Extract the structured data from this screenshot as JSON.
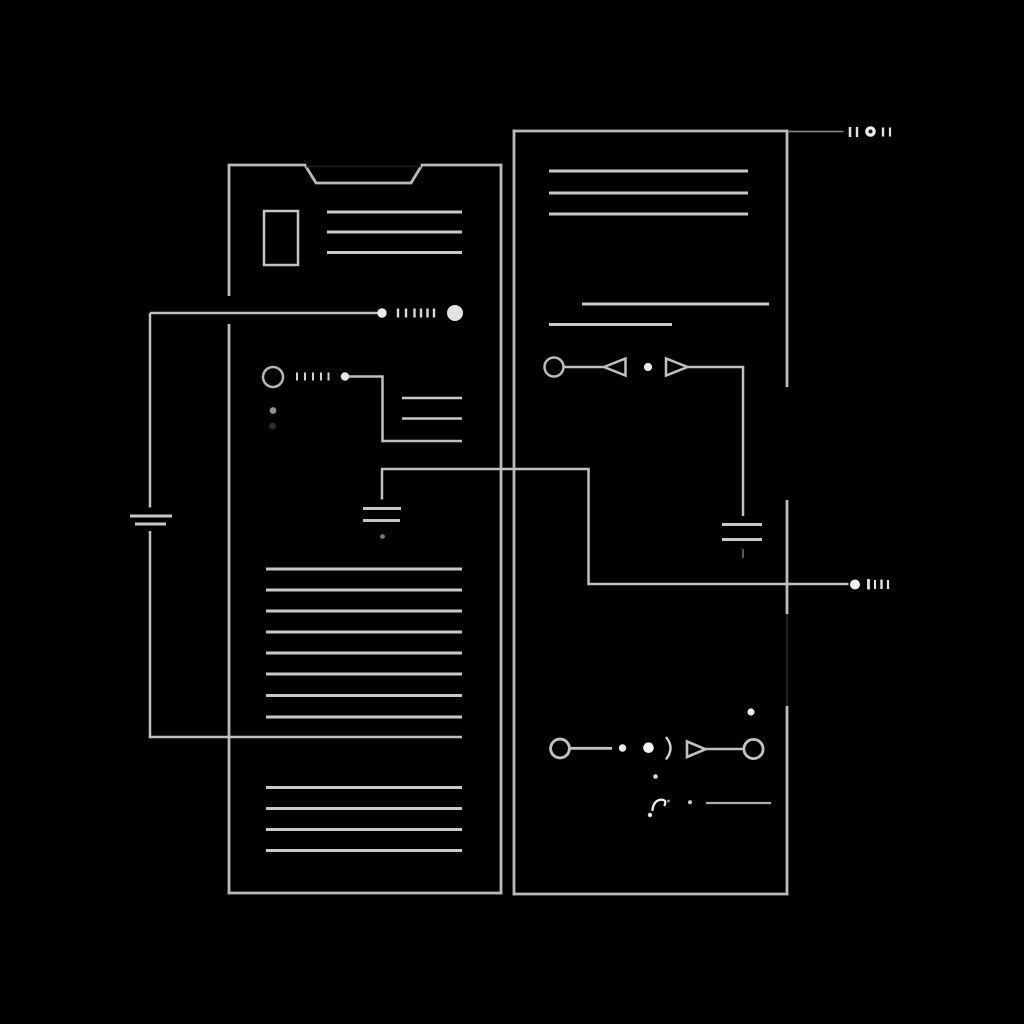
{
  "canvas": {
    "width": 1024,
    "height": 1024,
    "background": "#000000"
  },
  "palette": {
    "panel_stroke": "#b9b9b9",
    "text_line": "#c9c9c9",
    "wire": "#c0c0c0",
    "bright_dot": "#f2f2f2",
    "ghost": "#232323"
  },
  "shapes": [
    {
      "name": "left-panel-edge-left-upper",
      "type": "line",
      "x1": 229,
      "y1": 165,
      "x2": 229,
      "y2": 296,
      "w": 2.8,
      "color": "#b9b9b9"
    },
    {
      "name": "left-panel-edge-left-lower",
      "type": "line",
      "x1": 229,
      "y1": 324,
      "x2": 229,
      "y2": 894.4,
      "w": 2.8,
      "color": "#b9b9b9"
    },
    {
      "name": "left-panel-edge-right",
      "type": "line",
      "x1": 501,
      "y1": 163.6,
      "x2": 501,
      "y2": 894.4,
      "w": 2.8,
      "color": "#b9b9b9"
    },
    {
      "name": "left-panel-edge-top-left",
      "type": "line",
      "x1": 227.6,
      "y1": 165,
      "x2": 306,
      "y2": 165,
      "w": 2.8,
      "color": "#b9b9b9"
    },
    {
      "name": "left-panel-notch-left-slant",
      "type": "line",
      "x1": 305,
      "y1": 165,
      "x2": 316,
      "y2": 183,
      "w": 2.8,
      "color": "#b9b9b9"
    },
    {
      "name": "left-panel-notch-bottom",
      "type": "line",
      "x1": 315,
      "y1": 183,
      "x2": 412,
      "y2": 183,
      "w": 2.8,
      "color": "#b9b9b9"
    },
    {
      "name": "left-panel-notch-right-slant",
      "type": "line",
      "x1": 411,
      "y1": 183,
      "x2": 422,
      "y2": 165,
      "w": 2.8,
      "color": "#b9b9b9"
    },
    {
      "name": "left-panel-edge-top-right",
      "type": "line",
      "x1": 421,
      "y1": 165,
      "x2": 502.4,
      "y2": 165,
      "w": 2.8,
      "color": "#b9b9b9"
    },
    {
      "name": "left-panel-notch-ghost-line",
      "type": "line",
      "x1": 306,
      "y1": 166.5,
      "x2": 421,
      "y2": 166.5,
      "w": 1.5,
      "color": "#1d1d1d"
    },
    {
      "name": "left-panel-edge-bottom",
      "type": "line",
      "x1": 227.6,
      "y1": 893,
      "x2": 502.4,
      "y2": 893,
      "w": 2.8,
      "color": "#b9b9b9"
    },
    {
      "name": "right-panel-edge-left",
      "type": "line",
      "x1": 514,
      "y1": 129.6,
      "x2": 514,
      "y2": 895.4,
      "w": 2.8,
      "color": "#b9b9b9"
    },
    {
      "name": "right-panel-edge-top",
      "type": "line",
      "x1": 512.6,
      "y1": 131,
      "x2": 788.4,
      "y2": 131,
      "w": 2.8,
      "color": "#b9b9b9"
    },
    {
      "name": "right-panel-edge-right-upper",
      "type": "line",
      "x1": 787,
      "y1": 129.6,
      "x2": 787,
      "y2": 387,
      "w": 2.8,
      "color": "#b9b9b9"
    },
    {
      "name": "right-panel-edge-right-middle",
      "type": "line",
      "x1": 787,
      "y1": 500,
      "x2": 787,
      "y2": 614,
      "w": 2.8,
      "color": "#b9b9b9"
    },
    {
      "name": "right-panel-edge-right-ghost",
      "type": "line",
      "x1": 787,
      "y1": 614,
      "x2": 787,
      "y2": 706,
      "w": 2,
      "color": "#232323"
    },
    {
      "name": "right-panel-edge-right-lower",
      "type": "line",
      "x1": 787,
      "y1": 706,
      "x2": 787,
      "y2": 895.4,
      "w": 2.8,
      "color": "#b9b9b9"
    },
    {
      "name": "right-panel-edge-bottom",
      "type": "line",
      "x1": 512.6,
      "y1": 894,
      "x2": 788.4,
      "y2": 894,
      "w": 2.8,
      "color": "#b9b9b9"
    },
    {
      "name": "left-panel-small-rect",
      "type": "rect",
      "x": 264,
      "y": 211,
      "width": 34,
      "height": 54,
      "s": 2.5,
      "color": "#c3c3c3"
    },
    {
      "name": "left-text-line-a1",
      "type": "line",
      "x1": 327,
      "y1": 212,
      "x2": 462,
      "y2": 212,
      "w": 3,
      "color": "#c9c9c9"
    },
    {
      "name": "left-text-line-a2",
      "type": "line",
      "x1": 327,
      "y1": 232,
      "x2": 462,
      "y2": 232,
      "w": 3,
      "color": "#c9c9c9"
    },
    {
      "name": "left-text-line-a3",
      "type": "line",
      "x1": 327,
      "y1": 252.5,
      "x2": 462,
      "y2": 252.5,
      "w": 3,
      "color": "#c9c9c9"
    },
    {
      "name": "wire-row1-horizontal",
      "type": "line",
      "x1": 150,
      "y1": 313,
      "x2": 377.5,
      "y2": 313,
      "w": 2.5,
      "color": "#c0c0c0"
    },
    {
      "name": "wire-row1-node-dot",
      "type": "dot",
      "cx": 382,
      "cy": 313,
      "r": 4.7,
      "color": "#ececec"
    },
    {
      "name": "wire-row1-tick-1",
      "type": "line",
      "x1": 398,
      "y1": 308.5,
      "x2": 398,
      "y2": 317.5,
      "w": 2.4,
      "color": "#d8d8d8"
    },
    {
      "name": "wire-row1-tick-2",
      "type": "line",
      "x1": 406,
      "y1": 308.5,
      "x2": 406,
      "y2": 317.5,
      "w": 2.4,
      "color": "#d8d8d8"
    },
    {
      "name": "wire-row1-tick-3",
      "type": "line",
      "x1": 414.5,
      "y1": 308.5,
      "x2": 414.5,
      "y2": 317.5,
      "w": 2.4,
      "color": "#d8d8d8"
    },
    {
      "name": "wire-row1-tick-4",
      "type": "line",
      "x1": 421,
      "y1": 308.5,
      "x2": 421,
      "y2": 317.5,
      "w": 2.4,
      "color": "#d8d8d8"
    },
    {
      "name": "wire-row1-tick-5",
      "type": "line",
      "x1": 427.5,
      "y1": 308.5,
      "x2": 427.5,
      "y2": 317.5,
      "w": 2.4,
      "color": "#d8d8d8"
    },
    {
      "name": "wire-row1-tick-6",
      "type": "line",
      "x1": 434,
      "y1": 308.5,
      "x2": 434,
      "y2": 317.5,
      "w": 2.4,
      "color": "#d8d8d8"
    },
    {
      "name": "wire-row1-terminal-circle",
      "type": "dot",
      "cx": 455,
      "cy": 313,
      "r": 8,
      "color": "#e2e2e2"
    },
    {
      "name": "left-wire-vertical-upper",
      "type": "line",
      "x1": 150,
      "y1": 313,
      "x2": 150,
      "y2": 507.5,
      "w": 2.5,
      "color": "#c0c0c0"
    },
    {
      "name": "left-ground-bar-1",
      "type": "line",
      "x1": 130,
      "y1": 516,
      "x2": 172,
      "y2": 516,
      "w": 3,
      "color": "#c6c6c6"
    },
    {
      "name": "left-ground-bar-2",
      "type": "line",
      "x1": 135,
      "y1": 524,
      "x2": 166,
      "y2": 524,
      "w": 3,
      "color": "#c6c6c6"
    },
    {
      "name": "left-wire-vertical-lower",
      "type": "line",
      "x1": 150,
      "y1": 531,
      "x2": 150,
      "y2": 738.2,
      "w": 2.5,
      "color": "#c0c0c0"
    },
    {
      "name": "left-wire-horizontal-bottom",
      "type": "line",
      "x1": 148.8,
      "y1": 737,
      "x2": 462,
      "y2": 737,
      "w": 2.5,
      "color": "#c0c0c0"
    },
    {
      "name": "circle-row-circle",
      "type": "circle",
      "cx": 273,
      "cy": 377,
      "r": 10,
      "s": 2.5,
      "color": "#b5b5b5"
    },
    {
      "name": "circle-row-tick-1",
      "type": "line",
      "x1": 297,
      "y1": 372.5,
      "x2": 297,
      "y2": 380.5,
      "w": 2,
      "color": "#cfcfcf"
    },
    {
      "name": "circle-row-tick-2",
      "type": "line",
      "x1": 305,
      "y1": 372.5,
      "x2": 305,
      "y2": 380.5,
      "w": 2,
      "color": "#cfcfcf"
    },
    {
      "name": "circle-row-tick-3",
      "type": "line",
      "x1": 313,
      "y1": 372.5,
      "x2": 313,
      "y2": 380.5,
      "w": 2,
      "color": "#cfcfcf"
    },
    {
      "name": "circle-row-tick-4",
      "type": "line",
      "x1": 321,
      "y1": 372.5,
      "x2": 321,
      "y2": 380.5,
      "w": 2,
      "color": "#cfcfcf"
    },
    {
      "name": "circle-row-tick-5",
      "type": "line",
      "x1": 328.5,
      "y1": 372.5,
      "x2": 328.5,
      "y2": 380.5,
      "w": 2,
      "color": "#cfcfcf"
    },
    {
      "name": "circle-row-dot",
      "type": "dot",
      "cx": 345,
      "cy": 376.5,
      "r": 4.2,
      "color": "#e8e8e8"
    },
    {
      "name": "circle-row-wire-h1",
      "type": "line",
      "x1": 349,
      "y1": 376.5,
      "x2": 383.7,
      "y2": 376.5,
      "w": 2.5,
      "color": "#c0c0c0"
    },
    {
      "name": "circle-row-wire-v",
      "type": "line",
      "x1": 382.5,
      "y1": 376.5,
      "x2": 382.5,
      "y2": 442.2,
      "w": 2.5,
      "color": "#c0c0c0"
    },
    {
      "name": "circle-row-wire-h2",
      "type": "line",
      "x1": 382.5,
      "y1": 441,
      "x2": 462,
      "y2": 441,
      "w": 2.5,
      "color": "#c0c0c0"
    },
    {
      "name": "left-text-line-b1",
      "type": "line",
      "x1": 402,
      "y1": 398,
      "x2": 462,
      "y2": 398,
      "w": 2.6,
      "color": "#c9c9c9"
    },
    {
      "name": "left-text-line-b2",
      "type": "line",
      "x1": 402,
      "y1": 418.5,
      "x2": 462,
      "y2": 418.5,
      "w": 2.6,
      "color": "#c9c9c9"
    },
    {
      "name": "small-gray-dot",
      "type": "dot",
      "cx": 273,
      "cy": 410.5,
      "r": 3.4,
      "color": "#8f8f8f"
    },
    {
      "name": "small-dark-dot",
      "type": "dot",
      "cx": 272.5,
      "cy": 426,
      "r": 3.4,
      "color": "#2d2d2d"
    },
    {
      "name": "mid-wire-horizontal",
      "type": "line",
      "x1": 381,
      "y1": 469,
      "x2": 589.7,
      "y2": 469,
      "w": 2.5,
      "color": "#c0c0c0"
    },
    {
      "name": "mid-wire-vertical-left",
      "type": "line",
      "x1": 382,
      "y1": 469,
      "x2": 382,
      "y2": 499.5,
      "w": 2.5,
      "color": "#c0c0c0"
    },
    {
      "name": "mid-ground-bar-1",
      "type": "line",
      "x1": 363,
      "y1": 508.5,
      "x2": 401,
      "y2": 508.5,
      "w": 3,
      "color": "#c6c6c6"
    },
    {
      "name": "mid-ground-bar-2",
      "type": "line",
      "x1": 363,
      "y1": 520.5,
      "x2": 400,
      "y2": 520.5,
      "w": 3,
      "color": "#c6c6c6"
    },
    {
      "name": "mid-ground-dot",
      "type": "dot",
      "cx": 382.5,
      "cy": 536.5,
      "r": 2.4,
      "color": "#787878"
    },
    {
      "name": "mid-wire-vertical-right",
      "type": "line",
      "x1": 588.5,
      "y1": 469,
      "x2": 588.5,
      "y2": 585.2,
      "w": 2.5,
      "color": "#c0c0c0"
    },
    {
      "name": "mid-wire-horizontal-2",
      "type": "line",
      "x1": 588.5,
      "y1": 584,
      "x2": 848.5,
      "y2": 584,
      "w": 2.5,
      "color": "#c0c0c0"
    },
    {
      "name": "mid-wire-end-dot",
      "type": "dot",
      "cx": 855,
      "cy": 584.5,
      "r": 5,
      "color": "#f0f0f0"
    },
    {
      "name": "mid-wire-tick-1",
      "type": "line",
      "x1": 868.5,
      "y1": 579,
      "x2": 868.5,
      "y2": 589.5,
      "w": 2.8,
      "color": "#e3e3e3"
    },
    {
      "name": "mid-wire-tick-2",
      "type": "line",
      "x1": 875,
      "y1": 580,
      "x2": 875,
      "y2": 589,
      "w": 2,
      "color": "#e3e3e3"
    },
    {
      "name": "mid-wire-tick-3",
      "type": "line",
      "x1": 881.5,
      "y1": 579.5,
      "x2": 881.5,
      "y2": 589,
      "w": 2.4,
      "color": "#e3e3e3"
    },
    {
      "name": "mid-wire-tick-4",
      "type": "line",
      "x1": 888,
      "y1": 580,
      "x2": 888,
      "y2": 589,
      "w": 2.2,
      "color": "#e3e3e3"
    },
    {
      "name": "left-list1-line-1",
      "type": "line",
      "x1": 266,
      "y1": 569,
      "x2": 462,
      "y2": 569,
      "w": 3,
      "color": "#c9c9c9"
    },
    {
      "name": "left-list1-line-2",
      "type": "line",
      "x1": 266,
      "y1": 590,
      "x2": 462,
      "y2": 590,
      "w": 3,
      "color": "#c9c9c9"
    },
    {
      "name": "left-list1-line-3",
      "type": "line",
      "x1": 266,
      "y1": 611,
      "x2": 462,
      "y2": 611,
      "w": 3,
      "color": "#c9c9c9"
    },
    {
      "name": "left-list1-line-4",
      "type": "line",
      "x1": 266,
      "y1": 632,
      "x2": 462,
      "y2": 632,
      "w": 3,
      "color": "#c9c9c9"
    },
    {
      "name": "left-list1-line-5",
      "type": "line",
      "x1": 266,
      "y1": 653,
      "x2": 462,
      "y2": 653,
      "w": 3,
      "color": "#c9c9c9"
    },
    {
      "name": "left-list1-line-6",
      "type": "line",
      "x1": 266,
      "y1": 674,
      "x2": 462,
      "y2": 674,
      "w": 3,
      "color": "#c9c9c9"
    },
    {
      "name": "left-list1-line-7",
      "type": "line",
      "x1": 266,
      "y1": 695.5,
      "x2": 462,
      "y2": 695.5,
      "w": 3,
      "color": "#c9c9c9"
    },
    {
      "name": "left-list1-line-8",
      "type": "line",
      "x1": 266,
      "y1": 717,
      "x2": 462,
      "y2": 717,
      "w": 3,
      "color": "#c9c9c9"
    },
    {
      "name": "left-list2-line-1",
      "type": "line",
      "x1": 266,
      "y1": 787.5,
      "x2": 462,
      "y2": 787.5,
      "w": 3,
      "color": "#c9c9c9"
    },
    {
      "name": "left-list2-line-2",
      "type": "line",
      "x1": 266,
      "y1": 808.5,
      "x2": 462,
      "y2": 808.5,
      "w": 3,
      "color": "#c9c9c9"
    },
    {
      "name": "left-list2-line-3",
      "type": "line",
      "x1": 266,
      "y1": 829.5,
      "x2": 462,
      "y2": 829.5,
      "w": 3,
      "color": "#c9c9c9"
    },
    {
      "name": "left-list2-line-4",
      "type": "line",
      "x1": 266,
      "y1": 850.5,
      "x2": 462,
      "y2": 850.5,
      "w": 3,
      "color": "#c9c9c9"
    },
    {
      "name": "right-text-line-1",
      "type": "line",
      "x1": 549,
      "y1": 171,
      "x2": 748,
      "y2": 171,
      "w": 3,
      "color": "#c9c9c9"
    },
    {
      "name": "right-text-line-2",
      "type": "line",
      "x1": 549,
      "y1": 193,
      "x2": 748,
      "y2": 193,
      "w": 3,
      "color": "#c9c9c9"
    },
    {
      "name": "right-text-line-3",
      "type": "line",
      "x1": 549,
      "y1": 214,
      "x2": 748,
      "y2": 214,
      "w": 3,
      "color": "#c9c9c9"
    },
    {
      "name": "right-mid-line-a",
      "type": "line",
      "x1": 582,
      "y1": 304,
      "x2": 769,
      "y2": 304,
      "w": 3,
      "color": "#c9c9c9"
    },
    {
      "name": "right-mid-line-b",
      "type": "line",
      "x1": 549,
      "y1": 324.5,
      "x2": 672,
      "y2": 324.5,
      "w": 3,
      "color": "#c9c9c9"
    },
    {
      "name": "row1-circle",
      "type": "circle",
      "cx": 554,
      "cy": 367,
      "r": 9.5,
      "s": 2.5,
      "color": "#bcbcbc"
    },
    {
      "name": "row1-wire-1",
      "type": "line",
      "x1": 563.5,
      "y1": 367,
      "x2": 604,
      "y2": 367,
      "w": 2.5,
      "color": "#c0c0c0"
    },
    {
      "name": "row1-triangle-left",
      "type": "polygon",
      "points": "604,367 625.5,358.5 625.5,375.5",
      "s": 2.5,
      "color": "#c0c0c0"
    },
    {
      "name": "row1-dot",
      "type": "dot",
      "cx": 648,
      "cy": 367,
      "r": 4.1,
      "color": "#ececec"
    },
    {
      "name": "row1-triangle-right",
      "type": "polygon",
      "points": "666,358.5 666,375.5 687.5,367",
      "s": 2.5,
      "color": "#c0c0c0"
    },
    {
      "name": "row1-wire-2",
      "type": "line",
      "x1": 687,
      "y1": 367,
      "x2": 744.2,
      "y2": 367,
      "w": 2.5,
      "color": "#c0c0c0"
    },
    {
      "name": "row1-wire-vertical",
      "type": "line",
      "x1": 743,
      "y1": 367,
      "x2": 743,
      "y2": 516,
      "w": 2.5,
      "color": "#c0c0c0"
    },
    {
      "name": "right-ground-bar-1",
      "type": "line",
      "x1": 722,
      "y1": 524.5,
      "x2": 762,
      "y2": 524.5,
      "w": 3,
      "color": "#c6c6c6"
    },
    {
      "name": "right-ground-bar-2",
      "type": "line",
      "x1": 722,
      "y1": 539.5,
      "x2": 762,
      "y2": 539.5,
      "w": 3,
      "color": "#c6c6c6"
    },
    {
      "name": "right-ground-tick",
      "type": "line",
      "x1": 743,
      "y1": 549,
      "x2": 743,
      "y2": 558,
      "w": 2,
      "color": "#565656"
    },
    {
      "name": "top-terminator-line",
      "type": "line",
      "x1": 788,
      "y1": 131.5,
      "x2": 843.5,
      "y2": 131.5,
      "w": 1.6,
      "color": "#8a8a8a"
    },
    {
      "name": "top-terminator-tick-1",
      "type": "line",
      "x1": 850,
      "y1": 127,
      "x2": 850,
      "y2": 137,
      "w": 2.6,
      "color": "#e0e0e0"
    },
    {
      "name": "top-terminator-tick-2",
      "type": "line",
      "x1": 857,
      "y1": 127,
      "x2": 857,
      "y2": 137,
      "w": 2.4,
      "color": "#e0e0e0"
    },
    {
      "name": "top-terminator-ring",
      "type": "dot",
      "cx": 870.5,
      "cy": 131.5,
      "r": 5.3,
      "color": "#ececec"
    },
    {
      "name": "top-terminator-ring-center",
      "type": "dot",
      "cx": 870.5,
      "cy": 131.5,
      "r": 2,
      "color": "#161616"
    },
    {
      "name": "top-terminator-tick-3",
      "type": "line",
      "x1": 883,
      "y1": 127.5,
      "x2": 883,
      "y2": 136.5,
      "w": 2.4,
      "color": "#e0e0e0"
    },
    {
      "name": "top-terminator-tick-4",
      "type": "line",
      "x1": 890,
      "y1": 127.5,
      "x2": 890,
      "y2": 136.5,
      "w": 2.2,
      "color": "#e0e0e0"
    },
    {
      "name": "row2-circle-left",
      "type": "circle",
      "cx": 560,
      "cy": 748.5,
      "r": 9.4,
      "s": 2.9,
      "color": "#c2c2c2"
    },
    {
      "name": "row2-wire-1",
      "type": "line",
      "x1": 569.5,
      "y1": 748.3,
      "x2": 612,
      "y2": 748.3,
      "w": 2.9,
      "color": "#c0c0c0"
    },
    {
      "name": "row2-dot-small",
      "type": "dot",
      "cx": 622.5,
      "cy": 748,
      "r": 3.7,
      "color": "#eaeaea"
    },
    {
      "name": "row2-dot-large",
      "type": "dot",
      "cx": 648.5,
      "cy": 747.7,
      "r": 5.3,
      "color": "#f5f5f5"
    },
    {
      "name": "row2-paren-arc",
      "type": "path",
      "d": "M 666.5 737.8 Q 674.5 748 666.5 758.6",
      "s": 2.4,
      "color": "#cfcfcf"
    },
    {
      "name": "row2-triangle-right",
      "type": "polygon",
      "points": "687,741.5 687,757 705.5,749.2",
      "s": 2.6,
      "color": "#c2c2c2"
    },
    {
      "name": "row2-wire-2",
      "type": "line",
      "x1": 705.5,
      "y1": 749,
      "x2": 745,
      "y2": 749,
      "w": 2.6,
      "color": "#c0c0c0"
    },
    {
      "name": "row2-circle-right",
      "type": "circle",
      "cx": 753.5,
      "cy": 749,
      "r": 9.6,
      "s": 2.8,
      "color": "#c2c2c2"
    },
    {
      "name": "row2-dot-above",
      "type": "dot",
      "cx": 751,
      "cy": 712,
      "r": 3.6,
      "color": "#ededed"
    },
    {
      "name": "row2-dot-below",
      "type": "dot",
      "cx": 655.5,
      "cy": 776.5,
      "r": 2.3,
      "color": "#dcdcdc"
    },
    {
      "name": "bottom-scribble",
      "type": "path",
      "d": "M 652.5 810 Q 653.5 800.5 661 799.6 Q 667 799.6 664.6 805.2",
      "s": 2.3,
      "color": "#f0f0f0"
    },
    {
      "name": "bottom-scribble-dot",
      "type": "dot",
      "cx": 650,
      "cy": 815,
      "r": 2.2,
      "color": "#e5e5e5"
    },
    {
      "name": "bottom-scribble-speck",
      "type": "dot",
      "cx": 668.5,
      "cy": 801,
      "r": 1.4,
      "color": "#a0a0a0"
    },
    {
      "name": "bottom-dash-dot",
      "type": "dot",
      "cx": 690,
      "cy": 802.3,
      "r": 2,
      "color": "#cccccc"
    },
    {
      "name": "bottom-short-line",
      "type": "line",
      "x1": 706,
      "y1": 803,
      "x2": 771,
      "y2": 803,
      "w": 2.2,
      "color": "#ababab"
    }
  ]
}
